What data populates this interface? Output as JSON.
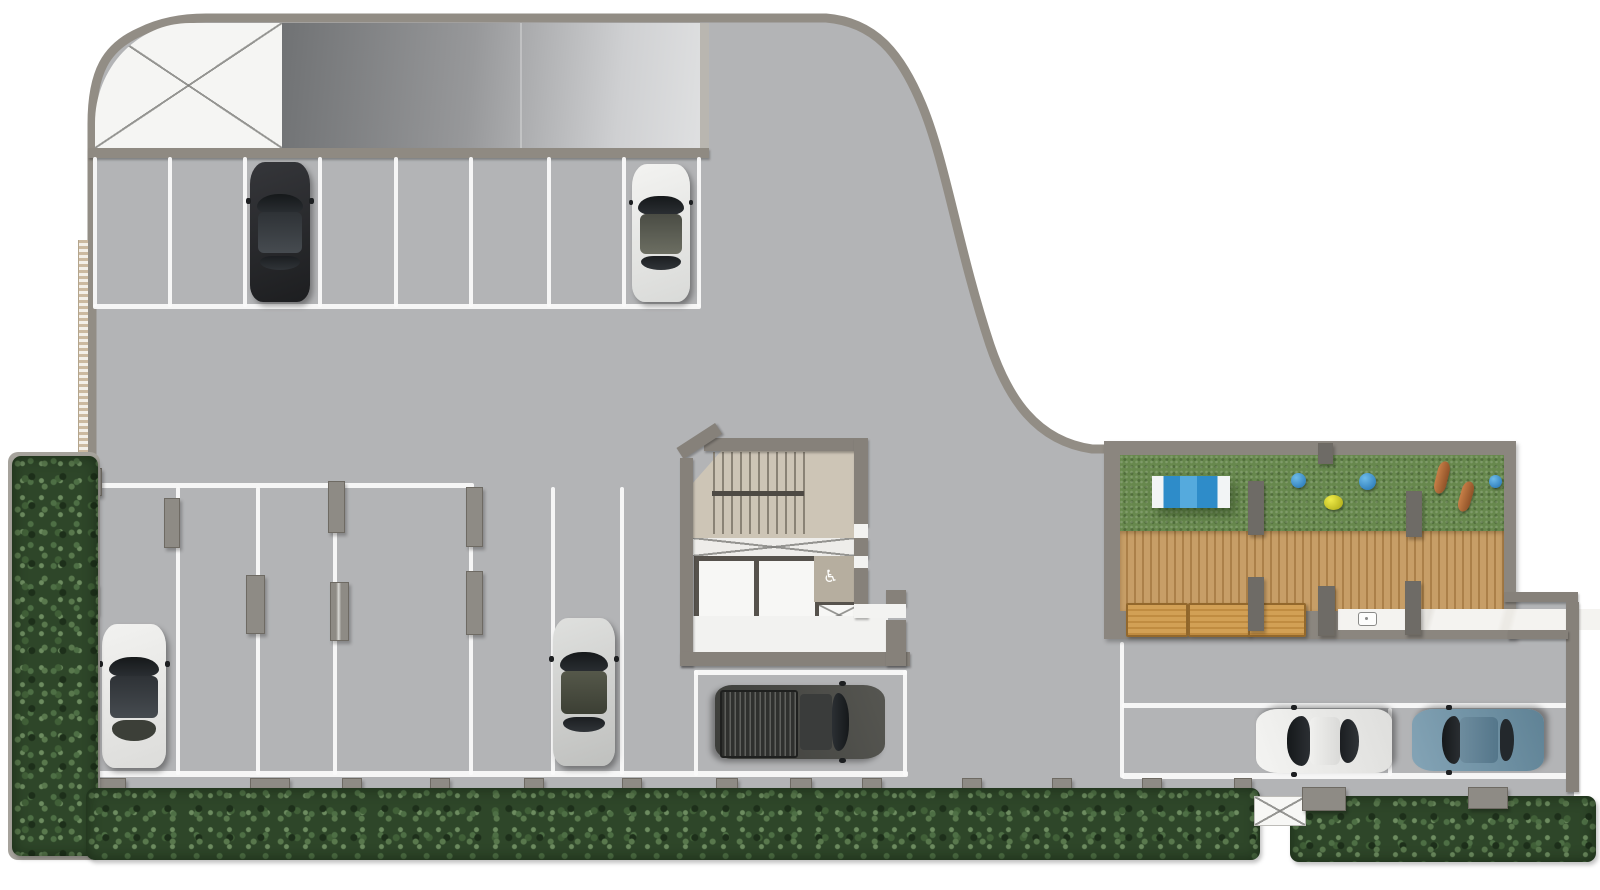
{
  "scene": {
    "type": "architectural-site-plan",
    "view": "top-down render",
    "subject": "Ground-level parking area with entry ramp, stair and elevator core, amenity deck and perimeter hedges",
    "background": "#ffffff"
  },
  "materials": {
    "asphalt": "#b3b4b6",
    "boundary_wall": "#928d85",
    "core_wall": "#86817a",
    "stair_floor": "#cdc5b6",
    "lobby_floor": "#f2f2f0",
    "grass": "#67884d",
    "timber_deck": "#c79e67",
    "stone_counter": "#f1f0ed",
    "hedge": "#2e4629",
    "marking_white": "#fafafa"
  },
  "ramp": {
    "direction_arrow": "right",
    "keep_clear_zone": "white-x-hatch"
  },
  "parking": {
    "top_row": {
      "spaces": 8,
      "occupied": [
        "black-sedan",
        "white-sedan"
      ]
    },
    "tandem_field": {
      "marked_lines": 7,
      "occupied": [
        "white-hatchback",
        "silver-sedan"
      ]
    },
    "service_bay": {
      "occupied": [
        "gray-pickup"
      ]
    },
    "east_row": {
      "spaces": 2,
      "occupied": [
        "white-coupe",
        "blue-sedan"
      ]
    }
  },
  "vehicles": [
    {
      "id": "black-sedan",
      "body": "#28292b"
    },
    {
      "id": "white-sedan",
      "body": "#ebecea"
    },
    {
      "id": "white-hatchback",
      "body": "#f0f0ee"
    },
    {
      "id": "silver-sedan",
      "body": "#d5d6d4"
    },
    {
      "id": "gray-pickup",
      "body": "#4b4b49"
    },
    {
      "id": "white-coupe",
      "body": "#f1f1ef"
    },
    {
      "id": "blue-sedan",
      "body": "#7294a8"
    }
  ],
  "core": {
    "rooms": [
      "stair",
      "elevator-1",
      "elevator-2",
      "accessible-wc",
      "service-shaft",
      "lobby"
    ],
    "wc_icon": "♿"
  },
  "amenity_deck": {
    "zones": [
      "lawn",
      "timber-deck",
      "counter-with-sink"
    ],
    "benches": 3,
    "canopy_stripes": [
      "#f2f4f5",
      "#2e8cc9",
      "#55aadd",
      "#2e8cc9",
      "#f2f4f5"
    ],
    "play_items": [
      {
        "shape": "dome",
        "color": "#2f84c4"
      },
      {
        "shape": "dome",
        "color": "#2f84c4"
      },
      {
        "shape": "dome",
        "color": "#d8d43a"
      },
      {
        "shape": "dome",
        "color": "#2f84c4"
      },
      {
        "shape": "canoe",
        "color": "#b06a3c"
      },
      {
        "shape": "canoe",
        "color": "#b06a3c"
      }
    ]
  },
  "landscape": {
    "hedge_strips": 3,
    "pedestrian_gate": "x-hatch",
    "left_trellis": true
  }
}
